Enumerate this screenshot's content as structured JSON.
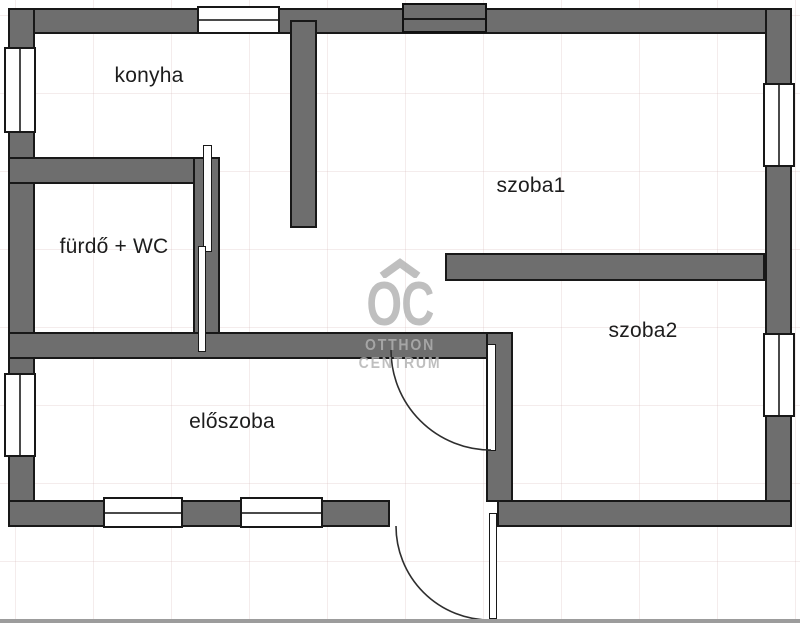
{
  "plan": {
    "title": "apartment floor plan",
    "rooms": [
      {
        "id": "konyha",
        "label": "konyha"
      },
      {
        "id": "szoba1",
        "label": "szoba1"
      },
      {
        "id": "szoba2",
        "label": "szoba2"
      },
      {
        "id": "furdo-wc",
        "label": "fürdő + WC"
      },
      {
        "id": "eloszoba",
        "label": "előszoba"
      }
    ],
    "watermark": {
      "monogram": "OC",
      "line1": "OTTHON",
      "line2": "CENTRUM"
    },
    "colors": {
      "wall_fill": "#6e6e6e",
      "wall_outline": "#181818",
      "window_fill": "#ffffff",
      "label_text": "#1d1d1d",
      "watermark_gray": "#b2b2b2",
      "grid_line": "#f3ecec",
      "bottom_bar": "#9c9c9c",
      "background": "#ffffff"
    }
  }
}
